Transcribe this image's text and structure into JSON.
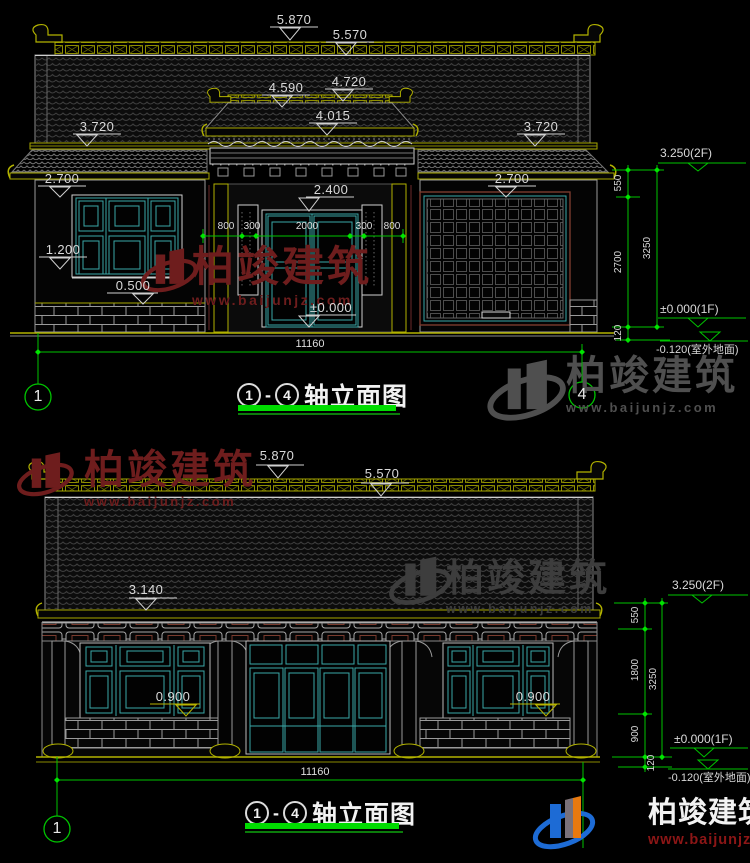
{
  "brand": {
    "name": "柏竣建筑",
    "url": "www.baijunjz.com"
  },
  "title": {
    "axis_from": "1",
    "axis_to": "4",
    "dash": "-",
    "text": "轴立面图"
  },
  "elev1": {
    "levels": {
      "ridge": "5.870",
      "tile_top": "5.570",
      "gate_ridge": "4.720",
      "gate_orn": "4.590",
      "gate_eave": "4.015",
      "eave_left": "3.720",
      "eave_right": "3.720",
      "skirt_left": "2.700",
      "skirt_right": "2.700",
      "door_top": "2.400",
      "sill": "1.200",
      "plinth": "0.500",
      "floor": "±0.000"
    },
    "chain": [
      "800",
      "300",
      "2000",
      "300",
      "800"
    ],
    "total": "11160",
    "right": {
      "lv2f": "3.250(2F)",
      "d1": "550",
      "d2": "2700",
      "d3": "120",
      "dsum": "3250",
      "lv1f": "±0.000(1F)",
      "lvg": "-0.120(室外地面)"
    },
    "axis_left": "1",
    "axis_right": "4"
  },
  "elev2": {
    "levels": {
      "ridge": "5.870",
      "tile_top": "5.570",
      "eave": "3.140",
      "sill_left": "0.900",
      "sill_right": "0.900"
    },
    "total": "11160",
    "right": {
      "lv2f": "3.250(2F)",
      "d1": "550",
      "d2": "1800",
      "d3": "900",
      "d4": "120",
      "dsum": "3250",
      "lv1f": "±0.000(1F)",
      "lvg": "-0.120(室外地面)"
    },
    "axis_left": "1"
  },
  "colors": {
    "background": "#000000",
    "roof_olive": "#b2b200",
    "window_teal": "#3aa8a8",
    "dimension_green": "#00c400",
    "underline_green": "#00dc00",
    "text_light": "#d9d9d9",
    "watermark_maroon": "#6e1d1d",
    "watermark_gray": "#4f4f4f",
    "logo_blue": "#1d6bd5",
    "logo_orange": "#e8790f",
    "logo_url_red": "#8c1616"
  }
}
